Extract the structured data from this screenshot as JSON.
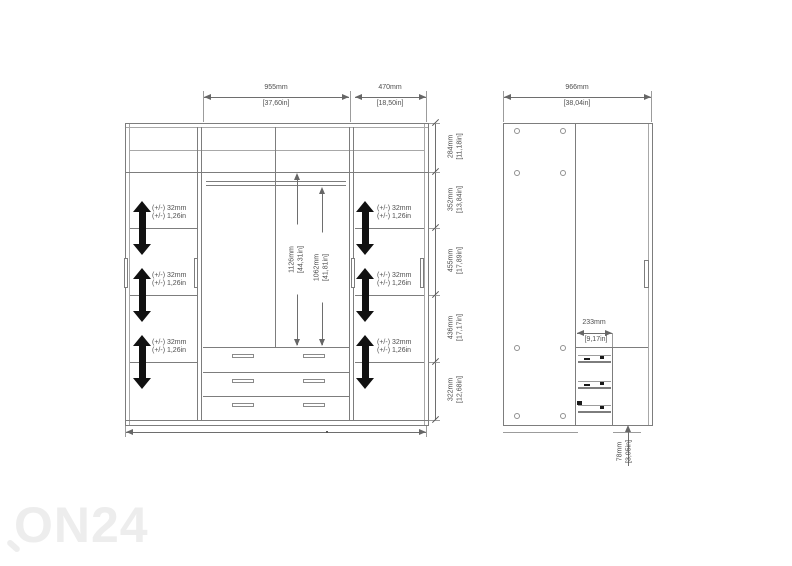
{
  "watermark": "ON24",
  "front_view": {
    "top_dims": [
      {
        "mm": "955mm",
        "in": "[37,60in]"
      },
      {
        "mm": "470mm",
        "in": "[18,50in]"
      }
    ],
    "height_chain": [
      {
        "mm": "284mm",
        "in": "[11,18in]"
      },
      {
        "mm": "352mm",
        "in": "[13,84in]"
      },
      {
        "mm": "455mm",
        "in": "[17,89in]"
      },
      {
        "mm": "436mm",
        "in": "[17,17in]"
      },
      {
        "mm": "322mm",
        "in": "[12,68in]"
      }
    ],
    "interior_dims": [
      {
        "mm": "1126mm",
        "in": "[44,31in]"
      },
      {
        "mm": "1062mm",
        "in": "[41,81in]"
      }
    ],
    "shelf_adjust": {
      "mm": "(+/-) 32mm",
      "in": "(+/-) 1,26in"
    }
  },
  "side_view": {
    "width_dim": {
      "mm": "966mm",
      "in": "[38,04in]"
    },
    "drawer_depth_dim": {
      "mm": "233mm",
      "in": "[9,17in]"
    },
    "plinth_dim": {
      "mm": "78mm",
      "in": "[3,05in]"
    }
  }
}
